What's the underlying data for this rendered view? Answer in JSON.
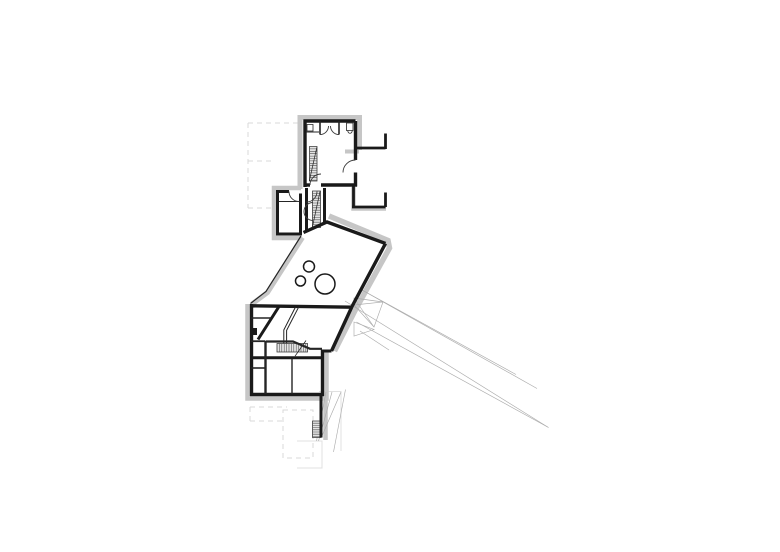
{
  "meta": {
    "canvas_width": 780,
    "canvas_height": 552,
    "background": "#ffffff"
  },
  "palette": {
    "wall": "#1a1a1a",
    "partition": "#252525",
    "arc": "#3a3a3a",
    "insulation": "#c6c6c6",
    "dashed": "#d9d9d9",
    "faint": "#e0e0e0",
    "projection": "#ababab",
    "hatch_fill": "#e3e3e3",
    "hatch_line": "#4d4d4d",
    "hatch_border": "#3a3a3a",
    "paper": "#ffffff"
  },
  "plan": {
    "layers": [
      {
        "name": "dashed-setback-outlines",
        "kind": "paths",
        "strokeRef": "dashed",
        "width": 1,
        "dash": "5 4",
        "paths": [
          "M248,123 L298,123",
          "M248,123 L248,208",
          "M248,161 L274,161",
          "M248,208 L276,208",
          "M250,407 L287,407",
          "M250,407 L250,421",
          "M250,421 L283,421",
          "M283,410 L313,410 L313,458 L283,458 Z"
        ]
      },
      {
        "name": "faint-terrace-outline",
        "kind": "paths",
        "strokeRef": "faint",
        "width": 1,
        "paths": [
          "M297,441 L322,441 L322,468 L297,468",
          "M319,391.5 L341,391.5 L341,451"
        ]
      },
      {
        "name": "insulation-bands",
        "kind": "paths",
        "strokeRef": "insulation",
        "width": 5,
        "paths": [
          "M300,189 L300,117.5 L359.5,117.5 L359.5,150",
          {
            "d": "M345,151.5 L359,151.5",
            "w": 4
          },
          {
            "d": "M353.5,187 L353.5,208.5 L386,208.5",
            "w": 4.5
          },
          {
            "d": "M301,188 L274,188 L274,238 L301,238",
            "w": 4.5
          },
          "M302.5,237.5 L267.5,292.5 L252,304",
          {
            "d": "M329,216 L388,240.5 L389.5,248 L355.5,309.5 L334.5,351",
            "w": 5.5
          },
          {
            "d": "M247.5,304 L247.5,398.5 L326.5,398.5 L326.5,350",
            "w": 4.5
          },
          {
            "d": "M325.5,398 L325.5,440",
            "w": 4.5
          }
        ]
      },
      {
        "name": "projection-lines",
        "kind": "paths",
        "strokeRef": "projection",
        "width": 0.65,
        "paths": [
          "M362,290 L537,388.5",
          "M362,290 L516,374.5",
          "M345,301 L548.5,427.5",
          "M356.5,322 L548.5,427.5",
          "M354,298 L383,302 L374,327 L354,305 Z",
          "M354,298 L374,327",
          "M383,302 L354,305",
          "M354,322 L374,329.5 L354,336 Z",
          "M360,331 L389,350",
          "M326,392 L316.5,441",
          "M332,392 L318.5,441",
          "M341,392 L321.5,437",
          "M345.5,389.5 L333.5,452"
        ]
      },
      {
        "name": "stair-hatches",
        "kind": "hatch",
        "fillRef": "hatch_fill",
        "strokeRef": "hatch_line",
        "lineWidth": 0.55,
        "borderRef": "hatch_border",
        "borderWidth": 0.8,
        "items": [
          {
            "name": "upper-stair",
            "x": 309.5,
            "y": 146.5,
            "w": 7.5,
            "h": 34.5,
            "dir": "h",
            "step": 2.4
          },
          {
            "name": "shaft-stair",
            "x": 312.5,
            "y": 191,
            "w": 8,
            "h": 36.5,
            "dir": "h",
            "step": 2.4
          },
          {
            "name": "lower-stair",
            "x": 277,
            "y": 343.5,
            "w": 30.5,
            "h": 8.5,
            "dir": "v",
            "step": 2.4
          },
          {
            "name": "basement-ladder",
            "x": 312.5,
            "y": 421,
            "w": 8.5,
            "h": 16.5,
            "dir": "h",
            "step": 2.2
          }
        ]
      },
      {
        "name": "exterior-walls",
        "kind": "paths",
        "strokeRef": "wall",
        "width": 3.4,
        "paths": [
          "M305,119.5 L305,187",
          "M303.5,121 L355.5,121",
          "M355.5,121 L355.5,160",
          "M355.5,172.5 L355.5,186.5",
          "M305,185 L310,185",
          "M321,185 L357,185",
          {
            "d": "M357,148 L385.5,148",
            "w": 2.8
          },
          {
            "d": "M385.5,133.5 L385.5,149",
            "w": 2.8
          },
          {
            "d": "M353.5,185 L353.5,207",
            "w": 2.8
          },
          {
            "d": "M352,207 L385.5,207",
            "w": 2.8
          },
          {
            "d": "M385.5,192.5 L385.5,207",
            "w": 2.8
          },
          {
            "d": "M277.5,190 L277.5,235.5",
            "w": 3
          },
          {
            "d": "M276,191.5 L289,191.5",
            "w": 3
          },
          {
            "d": "M300.5,193.5 L300.5,235.5",
            "w": 3
          },
          {
            "d": "M276,234 L302,234",
            "w": 3
          },
          {
            "d": "M306.5,188 L306.5,231",
            "w": 3
          },
          {
            "d": "M324.5,188 L324.5,223",
            "w": 3
          },
          "M303.5,232.5 L327,222 L385.5,243.5",
          "M385.5,243.5 L352,306.5 L331.5,351",
          "M250,305.8 L352,307.2",
          "M251.5,304 L251.5,396",
          "M250,394.5 L324,394.5",
          "M322.5,349.5 L322.5,396",
          {
            "d": "M331.5,351 L322.5,351",
            "w": 3
          },
          {
            "d": "M279,306.5 L258,339.5",
            "w": 3
          },
          {
            "d": "M250,357.8 L322,357.8",
            "w": 3
          },
          {
            "d": "M321,396 L321,437.5",
            "w": 3
          },
          {
            "d": "M250.5,328.5 L256.5,328.5 L256.5,334.5 L250.5,334.5 Z",
            "w": 1,
            "fill": "#1a1a1a"
          }
        ]
      },
      {
        "name": "interior-partitions",
        "kind": "paths",
        "strokeRef": "partition",
        "width": 1.6,
        "paths": [
          "M320,121 L320,134.5",
          "M339,121 L339,134.5",
          {
            "d": "M306.5,132 L319,132",
            "w": 1
          },
          {
            "d": "M307,124.5 L313,124.5 L313,131 L307,131 Z",
            "w": 0.8
          },
          {
            "d": "M346.5,123 L353,123 L353,130.5 L346.5,130.5 Z",
            "w": 0.8
          },
          {
            "d": "M347.8,130.5 C347.8,134.2 352.2,134.2 352.2,130.5",
            "w": 0.8
          },
          {
            "d": "M278.5,201.5 L299.5,201.5",
            "w": 0.9
          },
          "M251,318 L271,318",
          {
            "d": "M251,341.2 L265,341.2",
            "w": 1.8
          },
          "M251,368 L265,368",
          {
            "d": "M265.5,341 L265.5,394",
            "w": 2.4
          },
          {
            "d": "M265.5,341.5 L293,341.5 L310,348.8 L322,348.8",
            "w": 2.2
          },
          {
            "d": "M292,359 L292,394",
            "w": 1.4
          },
          {
            "d": "M295.5,307 L283.8,330 L283.8,343.2",
            "w": 1
          },
          {
            "d": "M298.6,307.2 L286.6,330.4 L286.6,343.2",
            "w": 1
          },
          {
            "d": "M295,356.2 L306,340.5",
            "w": 0.8
          },
          {
            "d": "M309.3,181 L316.8,147.5",
            "w": 0.7
          },
          {
            "d": "M312.3,227.5 L320,191.5",
            "w": 0.7
          },
          {
            "d": "M301,236 L266,291.5 L250.5,303.5",
            "w": 1.2
          }
        ]
      },
      {
        "name": "door-swing-arcs",
        "kind": "paths",
        "strokeRef": "arc",
        "width": 0.9,
        "paths": [
          "M355.5,160 A12.5,12.5 0 0 0 343,172.5",
          "M310,185 A11,11 0 0 1 321,174",
          "M289,191.5 A10,10 0 0 0 299,201.5",
          "M306.5,202 A10.5,10.5 0 0 0 317,191.5",
          "M320,134.5 A8.5,8.5 0 0 0 328.5,126",
          "M339,134.5 A8.5,8.5 0 0 1 330.5,126",
          "M313,202.5 A9,9 0 0 0 313,220.5"
        ]
      },
      {
        "name": "hall-circles",
        "kind": "circles",
        "strokeRef": "wall",
        "width": 1.5,
        "fill": "#ffffff",
        "items": [
          {
            "cx": 309,
            "cy": 266.5,
            "r": 5.5
          },
          {
            "cx": 300.5,
            "cy": 281,
            "r": 5
          },
          {
            "cx": 325,
            "cy": 284,
            "r": 10
          }
        ]
      }
    ]
  }
}
